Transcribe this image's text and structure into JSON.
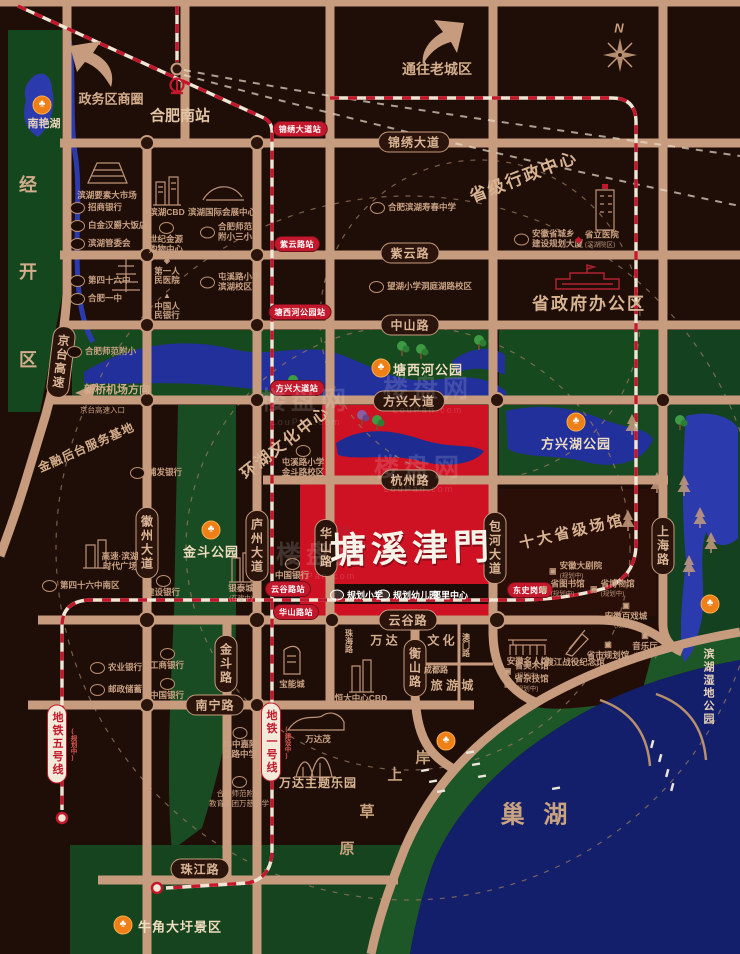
{
  "colors": {
    "bg": "#1f0e08",
    "road": "#c79b7d",
    "park_green": "#17491f",
    "water_blue": "#22309b",
    "chaohu_blue": "#131f6b",
    "project_red": "#ce1123",
    "metro_red": "#c3182b",
    "accent_orange": "#ef7f17"
  },
  "icons": {
    "park": "♣",
    "diamond": "◈",
    "tri": "▲",
    "reddia": "◆",
    "dot": "▣",
    "bullet": "•"
  },
  "watermark": {
    "mark": "楼盘网",
    "sub": "LouPan.com",
    "spots": [
      {
        "x": 306,
        "y": 404
      },
      {
        "x": 428,
        "y": 392
      },
      {
        "x": 419,
        "y": 471
      },
      {
        "x": 321,
        "y": 558
      }
    ]
  },
  "project": {
    "name": "塘溪津門"
  },
  "road_badges": [
    {
      "t": "锦绣大道",
      "x": 414,
      "y": 142,
      "o": "h"
    },
    {
      "t": "紫云路",
      "x": 410,
      "y": 253,
      "o": "h"
    },
    {
      "t": "中山路",
      "x": 410,
      "y": 325,
      "o": "h"
    },
    {
      "t": "方兴大道",
      "x": 409,
      "y": 401,
      "o": "h"
    },
    {
      "t": "杭州路",
      "x": 410,
      "y": 480,
      "o": "h"
    },
    {
      "t": "云谷路",
      "x": 408,
      "y": 620,
      "o": "h"
    },
    {
      "t": "南宁路",
      "x": 215,
      "y": 705,
      "o": "h"
    },
    {
      "t": "珠江路",
      "x": 200,
      "y": 869,
      "o": "h"
    },
    {
      "t": "徽州大道",
      "x": 147,
      "y": 543,
      "o": "v"
    },
    {
      "t": "庐州大道",
      "x": 257,
      "y": 546,
      "o": "v"
    },
    {
      "t": "华山路",
      "x": 326,
      "y": 548,
      "o": "v"
    },
    {
      "t": "包河大道",
      "x": 495,
      "y": 548,
      "o": "v"
    },
    {
      "t": "上海路",
      "x": 663,
      "y": 546,
      "o": "v"
    },
    {
      "t": "金斗路",
      "x": 226,
      "y": 664,
      "o": "v"
    },
    {
      "t": "衡山路",
      "x": 415,
      "y": 668,
      "o": "v"
    },
    {
      "t": "京台高速",
      "x": 61,
      "y": 362,
      "o": "v",
      "rot": 7
    }
  ],
  "stations": [
    {
      "t": "锦绣大道站",
      "x": 300,
      "y": 129
    },
    {
      "t": "紫云路站",
      "x": 297,
      "y": 244
    },
    {
      "t": "塘西河公园站",
      "x": 300,
      "y": 312
    },
    {
      "t": "方兴大道站",
      "x": 297,
      "y": 388
    },
    {
      "t": "云谷路站",
      "x": 288,
      "y": 589
    },
    {
      "t": "华山路站",
      "x": 296,
      "y": 612
    },
    {
      "t": "东史岗站",
      "x": 530,
      "y": 590
    }
  ],
  "metro_badges": [
    {
      "t": "地铁五号线",
      "note": "(规划中)",
      "x": 57,
      "y": 744
    },
    {
      "t": "地铁一号线",
      "note": "(建设中)",
      "x": 271,
      "y": 742
    }
  ],
  "parks": [
    {
      "t": "南艳湖",
      "ix": 42,
      "iy": 105,
      "tx": 44,
      "ty": 123
    },
    {
      "t": "塘西河公园",
      "ix": 381,
      "iy": 368,
      "tx": 428,
      "ty": 369,
      "big": 1
    },
    {
      "t": "方兴湖公园",
      "ix": 576,
      "iy": 422,
      "tx": 576,
      "ty": 443,
      "big": 1
    },
    {
      "t": "金斗公园",
      "ix": 211,
      "iy": 530,
      "tx": 211,
      "ty": 551,
      "big": 1
    },
    {
      "t": "滨湖湿地公园",
      "ix": 710,
      "iy": 604,
      "tx": 708,
      "ty": 648,
      "v": 1
    },
    {
      "t": "牛角大圩景区",
      "ix": 123,
      "iy": 925,
      "tx": 180,
      "ty": 926,
      "big": 1
    },
    {
      "t": "",
      "ix": 446,
      "iy": 741
    }
  ],
  "pois": [
    {
      "lines": [
        "滨湖要素大市场"
      ],
      "x": 107,
      "y": 191,
      "layout": "stack",
      "icon": "none"
    },
    {
      "lines": [
        "招商银行"
      ],
      "x": 70,
      "y": 208,
      "icon": "oval",
      "layout": "row"
    },
    {
      "lines": [
        "白金汉爵大饭店"
      ],
      "x": 70,
      "y": 226,
      "icon": "oval",
      "layout": "row"
    },
    {
      "lines": [
        "滨湖管委会"
      ],
      "x": 70,
      "y": 244,
      "icon": "oval",
      "layout": "row"
    },
    {
      "lines": [
        "第四十六中"
      ],
      "x": 70,
      "y": 281,
      "icon": "oval",
      "layout": "row"
    },
    {
      "lines": [
        "合肥一中"
      ],
      "x": 70,
      "y": 299,
      "icon": "oval",
      "layout": "row"
    },
    {
      "lines": [
        "合肥师范附小"
      ],
      "x": 67,
      "y": 352,
      "icon": "oval",
      "layout": "row"
    },
    {
      "lines": [
        "滨湖CBD"
      ],
      "x": 167,
      "y": 208,
      "layout": "stack",
      "icon": "none"
    },
    {
      "lines": [
        "世纪金源",
        "购物中心"
      ],
      "x": 166,
      "y": 222,
      "icon": "oval",
      "layout": "stack"
    },
    {
      "lines": [
        "第一人",
        "民医院"
      ],
      "x": 167,
      "y": 256,
      "icon": "diamond",
      "layout": "stack"
    },
    {
      "lines": [
        "中国人",
        "民银行"
      ],
      "x": 167,
      "y": 291,
      "icon": "tri",
      "layout": "stack"
    },
    {
      "lines": [
        "滨湖国际会展中心"
      ],
      "x": 222,
      "y": 208,
      "layout": "stack",
      "icon": "none"
    },
    {
      "lines": [
        "合肥师范",
        "附小三小"
      ],
      "x": 200,
      "y": 232,
      "icon": "oval",
      "layout": "row"
    },
    {
      "lines": [
        "屯溪路小学",
        "滨湖校区"
      ],
      "x": 200,
      "y": 282,
      "icon": "oval",
      "layout": "row"
    },
    {
      "lines": [
        "合肥滨湖寿春中学"
      ],
      "x": 370,
      "y": 208,
      "icon": "oval",
      "layout": "row"
    },
    {
      "lines": [
        "望湖小学洞庭湖路校区"
      ],
      "x": 369,
      "y": 287,
      "icon": "oval",
      "layout": "row"
    },
    {
      "lines": [
        "安徽省城乡",
        "建设规划大厦"
      ],
      "x": 514,
      "y": 239,
      "icon": "oval",
      "layout": "row"
    },
    {
      "lines": [
        "省立医院"
      ],
      "note": "(滨湖院区)",
      "x": 575,
      "y": 240,
      "icon": "reddia",
      "layout": "row"
    },
    {
      "lines": [
        "屯溪路小学",
        "金斗路校区"
      ],
      "note": "(筹建中)",
      "x": 303,
      "y": 445,
      "icon": "oval",
      "layout": "stack"
    },
    {
      "lines": [
        "高速·滨湖",
        "时代广场"
      ],
      "x": 120,
      "y": 552,
      "icon": "none",
      "layout": "stack"
    },
    {
      "lines": [
        "第四十六中南区"
      ],
      "x": 42,
      "y": 586,
      "icon": "oval",
      "layout": "row"
    },
    {
      "lines": [
        "浦发银行"
      ],
      "x": 130,
      "y": 473,
      "icon": "oval",
      "layout": "row"
    },
    {
      "lines": [
        "建设银行"
      ],
      "x": 163,
      "y": 575,
      "icon": "oval",
      "layout": "stack"
    },
    {
      "lines": [
        "银泰城"
      ],
      "note": "(在建中)",
      "x": 241,
      "y": 584,
      "icon": "none",
      "layout": "stack"
    },
    {
      "lines": [
        "中国银行"
      ],
      "x": 292,
      "y": 558,
      "icon": "oval",
      "layout": "stack"
    },
    {
      "lines": [
        "农业银行"
      ],
      "x": 90,
      "y": 668,
      "icon": "oval",
      "layout": "row"
    },
    {
      "lines": [
        "邮政储蓄"
      ],
      "x": 90,
      "y": 690,
      "icon": "oval",
      "layout": "row"
    },
    {
      "lines": [
        "工商银行"
      ],
      "x": 167,
      "y": 648,
      "icon": "oval",
      "layout": "stack"
    },
    {
      "lines": [
        "中国银行"
      ],
      "x": 167,
      "y": 678,
      "icon": "oval",
      "layout": "stack"
    },
    {
      "lines": [
        "48中嘉陵",
        "江路中学"
      ],
      "x": 240,
      "y": 727,
      "icon": "oval",
      "layout": "stack"
    },
    {
      "lines": [
        "合肥师范附小",
        "教育集团万慈小学"
      ],
      "x": 239,
      "y": 776,
      "icon": "oval",
      "layout": "stack",
      "tiny": 1
    },
    {
      "lines": [
        "宝能城"
      ],
      "x": 292,
      "y": 680,
      "layout": "stack",
      "icon": "none"
    },
    {
      "lines": [
        "恒大中心CBD"
      ],
      "x": 361,
      "y": 694,
      "layout": "stack",
      "icon": "none"
    },
    {
      "lines": [
        "万达茂"
      ],
      "x": 318,
      "y": 735,
      "layout": "stack",
      "icon": "none"
    },
    {
      "lines": [
        "万达主题乐园"
      ],
      "x": 318,
      "y": 779,
      "layout": "stack",
      "icon": "none",
      "big": 1
    },
    {
      "lines": [
        "安徽大剧院"
      ],
      "note": "(规划中)",
      "x": 549,
      "y": 571,
      "icon": "dot",
      "layout": "row"
    },
    {
      "lines": [
        "省图书馆"
      ],
      "note": "(规划中)",
      "x": 540,
      "y": 589,
      "icon": "dot",
      "layout": "row"
    },
    {
      "lines": [
        "省博物馆"
      ],
      "note": "(规划中)",
      "x": 590,
      "y": 589,
      "icon": "dot",
      "layout": "row"
    },
    {
      "lines": [
        "安徽百戏城"
      ],
      "note": "(规划中)",
      "x": 626,
      "y": 601,
      "icon": "dot",
      "layout": "stack"
    },
    {
      "lines": [
        "音乐厅"
      ],
      "note": "(规划中)",
      "x": 645,
      "y": 631,
      "icon": "dot",
      "layout": "stack"
    },
    {
      "lines": [
        "省市规划馆"
      ],
      "x": 608,
      "y": 640,
      "icon": "dot",
      "layout": "stack"
    },
    {
      "lines": [
        "渡江战役纪念馆"
      ],
      "x": 575,
      "y": 658,
      "layout": "stack",
      "icon": "none"
    },
    {
      "lines": [
        "安徽名人馆"
      ],
      "x": 528,
      "y": 657,
      "layout": "stack",
      "icon": "none"
    },
    {
      "lines": [
        "省美术馆"
      ],
      "note": "(规划中)",
      "x": 504,
      "y": 671,
      "icon": "dot",
      "layout": "row"
    },
    {
      "lines": [
        "省杂技馆"
      ],
      "note": "(规划中)",
      "x": 504,
      "y": 684,
      "icon": "dot",
      "layout": "row"
    },
    {
      "lines": [
        "京台高速入口"
      ],
      "x": 80,
      "y": 410,
      "layout": "row",
      "icon": "none",
      "tiny": 1,
      "bullet": 1
    }
  ],
  "facilities": [
    {
      "t": "规划小学",
      "x": 330,
      "y": 595,
      "icon": true
    },
    {
      "t": "规划幼儿园",
      "x": 376,
      "y": 595,
      "icon": true
    },
    {
      "t": "邻里中心",
      "x": 432,
      "y": 595,
      "icon": false
    }
  ],
  "texts": [
    {
      "t": "政务区商圈",
      "x": 111,
      "y": 98,
      "s": 13
    },
    {
      "t": "合肥南站",
      "x": 180,
      "y": 115,
      "s": 15,
      "c": "#e2c4a4"
    },
    {
      "t": "通往老城区",
      "x": 437,
      "y": 69,
      "s": 14
    },
    {
      "t": "省级行政中心",
      "x": 523,
      "y": 175,
      "s": 17,
      "rot": -21,
      "ls": 2,
      "c": "#d8b392"
    },
    {
      "t": "省政府办公区",
      "x": 589,
      "y": 302,
      "s": 17,
      "ls": 2,
      "c": "#d8b392"
    },
    {
      "t": "环湖文化中心",
      "x": 284,
      "y": 441,
      "s": 16,
      "rot": -38,
      "ls": 2,
      "c": "#d8b392"
    },
    {
      "t": "十大省级场馆",
      "x": 572,
      "y": 531,
      "s": 15,
      "rot": -13,
      "ls": 3,
      "c": "#d8b392"
    },
    {
      "t": "金融后台服务基地",
      "x": 86,
      "y": 447,
      "s": 12,
      "rot": -24,
      "ls": 1
    },
    {
      "t": "新桥机场方向",
      "x": 117,
      "y": 389,
      "s": 11
    },
    {
      "t": "经",
      "x": 28,
      "y": 184,
      "s": 18
    },
    {
      "t": "开",
      "x": 28,
      "y": 271,
      "s": 18
    },
    {
      "t": "区",
      "x": 28,
      "y": 359,
      "s": 18
    },
    {
      "t": "巢 湖",
      "x": 537,
      "y": 812,
      "s": 24,
      "ls": 6,
      "c": "#c9a37f"
    },
    {
      "t": "岸",
      "x": 423,
      "y": 757,
      "s": 15,
      "c": "#c9a37f"
    },
    {
      "t": "上",
      "x": 395,
      "y": 774,
      "s": 15,
      "c": "#c9a37f"
    },
    {
      "t": "草",
      "x": 367,
      "y": 811,
      "s": 15,
      "c": "#c9a37f"
    },
    {
      "t": "原",
      "x": 347,
      "y": 848,
      "s": 15,
      "c": "#c9a37f"
    },
    {
      "t": "万  达",
      "x": 384,
      "y": 640,
      "s": 12
    },
    {
      "t": "文  化",
      "x": 441,
      "y": 640,
      "s": 12
    },
    {
      "t": "旅 游 城",
      "x": 452,
      "y": 685,
      "s": 12
    },
    {
      "t": "珠海路",
      "x": 349,
      "y": 641,
      "s": 8,
      "v": 1
    },
    {
      "t": "澳门路",
      "x": 466,
      "y": 645,
      "s": 8,
      "v": 1
    },
    {
      "t": "成都路",
      "x": 436,
      "y": 670,
      "s": 8
    },
    {
      "t": "N",
      "x": 619,
      "y": 28,
      "s": 13,
      "i": 1,
      "c": "#c79b7d"
    }
  ]
}
